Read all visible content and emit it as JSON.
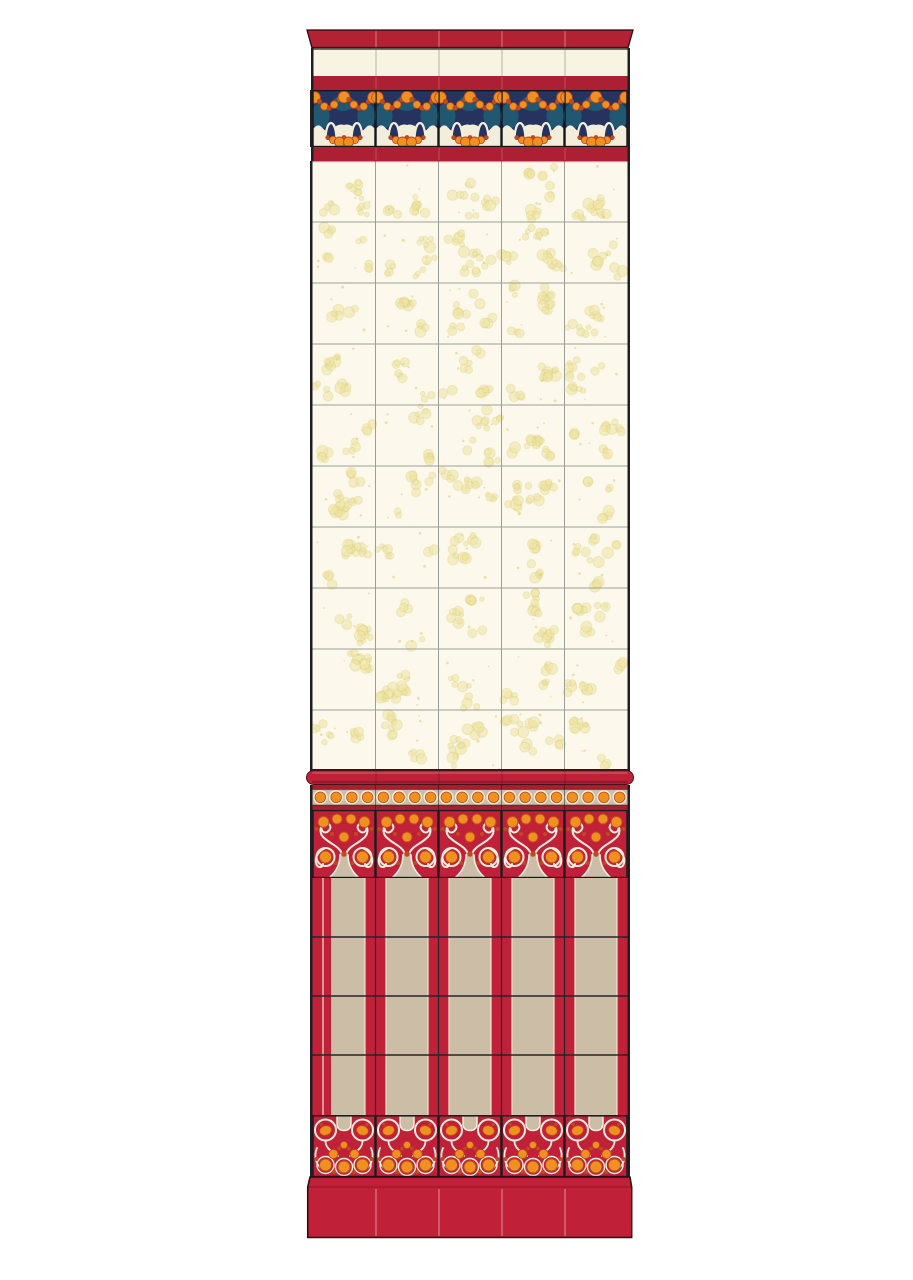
{
  "illustration": {
    "name": "Art Nouveau ceramic tile wall panel plate",
    "columns": 5,
    "tile_width_px": 63,
    "field_rows": 10,
    "dado_rows": 4,
    "sections": [
      {
        "id": "cornice-molding",
        "label": "red cornice cap course"
      },
      {
        "id": "plain-tile-course",
        "label": "plain ivory tile course"
      },
      {
        "id": "red-border-top",
        "label": "red border stripe"
      },
      {
        "id": "art-nouveau-frieze",
        "label": "frieze tiles with orange berry garland on blue ground and white arches"
      },
      {
        "id": "red-border-bottom",
        "label": "red border stripe"
      },
      {
        "id": "wall-field-tiles",
        "label": "ivory field tiles with pale yellow bubble sprays"
      },
      {
        "id": "chair-rail-molding",
        "label": "red bullnose rail"
      },
      {
        "id": "dot-border-band",
        "label": "orange dot border on tan ground"
      },
      {
        "id": "dado-frieze-band",
        "label": "dado frieze with white scrolls and orange berries on red"
      },
      {
        "id": "dado-panel-tiles",
        "label": "tan dado panels between red pilaster strips"
      },
      {
        "id": "base-frieze-band",
        "label": "base frieze with berry clusters on red"
      },
      {
        "id": "plinth-base",
        "label": "red plinth course"
      }
    ],
    "palette": {
      "page_bg": "#ffffff",
      "cornice_red": "#b32134",
      "stripe_red": "#ad1f32",
      "crimson": "#c02139",
      "dark_red": "#a81e31",
      "deep_red_line": "#4a0f18",
      "ivory": "#fcf9ec",
      "cream_tile": "#f8f4e3",
      "frieze_cream": "#f3eedb",
      "pale_yellow": "#efe5a4",
      "pale_yellow_ring": "#decf7a",
      "tan": "#cbbda6",
      "navy": "#26335f",
      "teal": "#1d6f7d",
      "orange": "#ef9120",
      "rust": "#c0491d",
      "outline": "#1f1f23",
      "grout": "#9b9e96"
    }
  }
}
